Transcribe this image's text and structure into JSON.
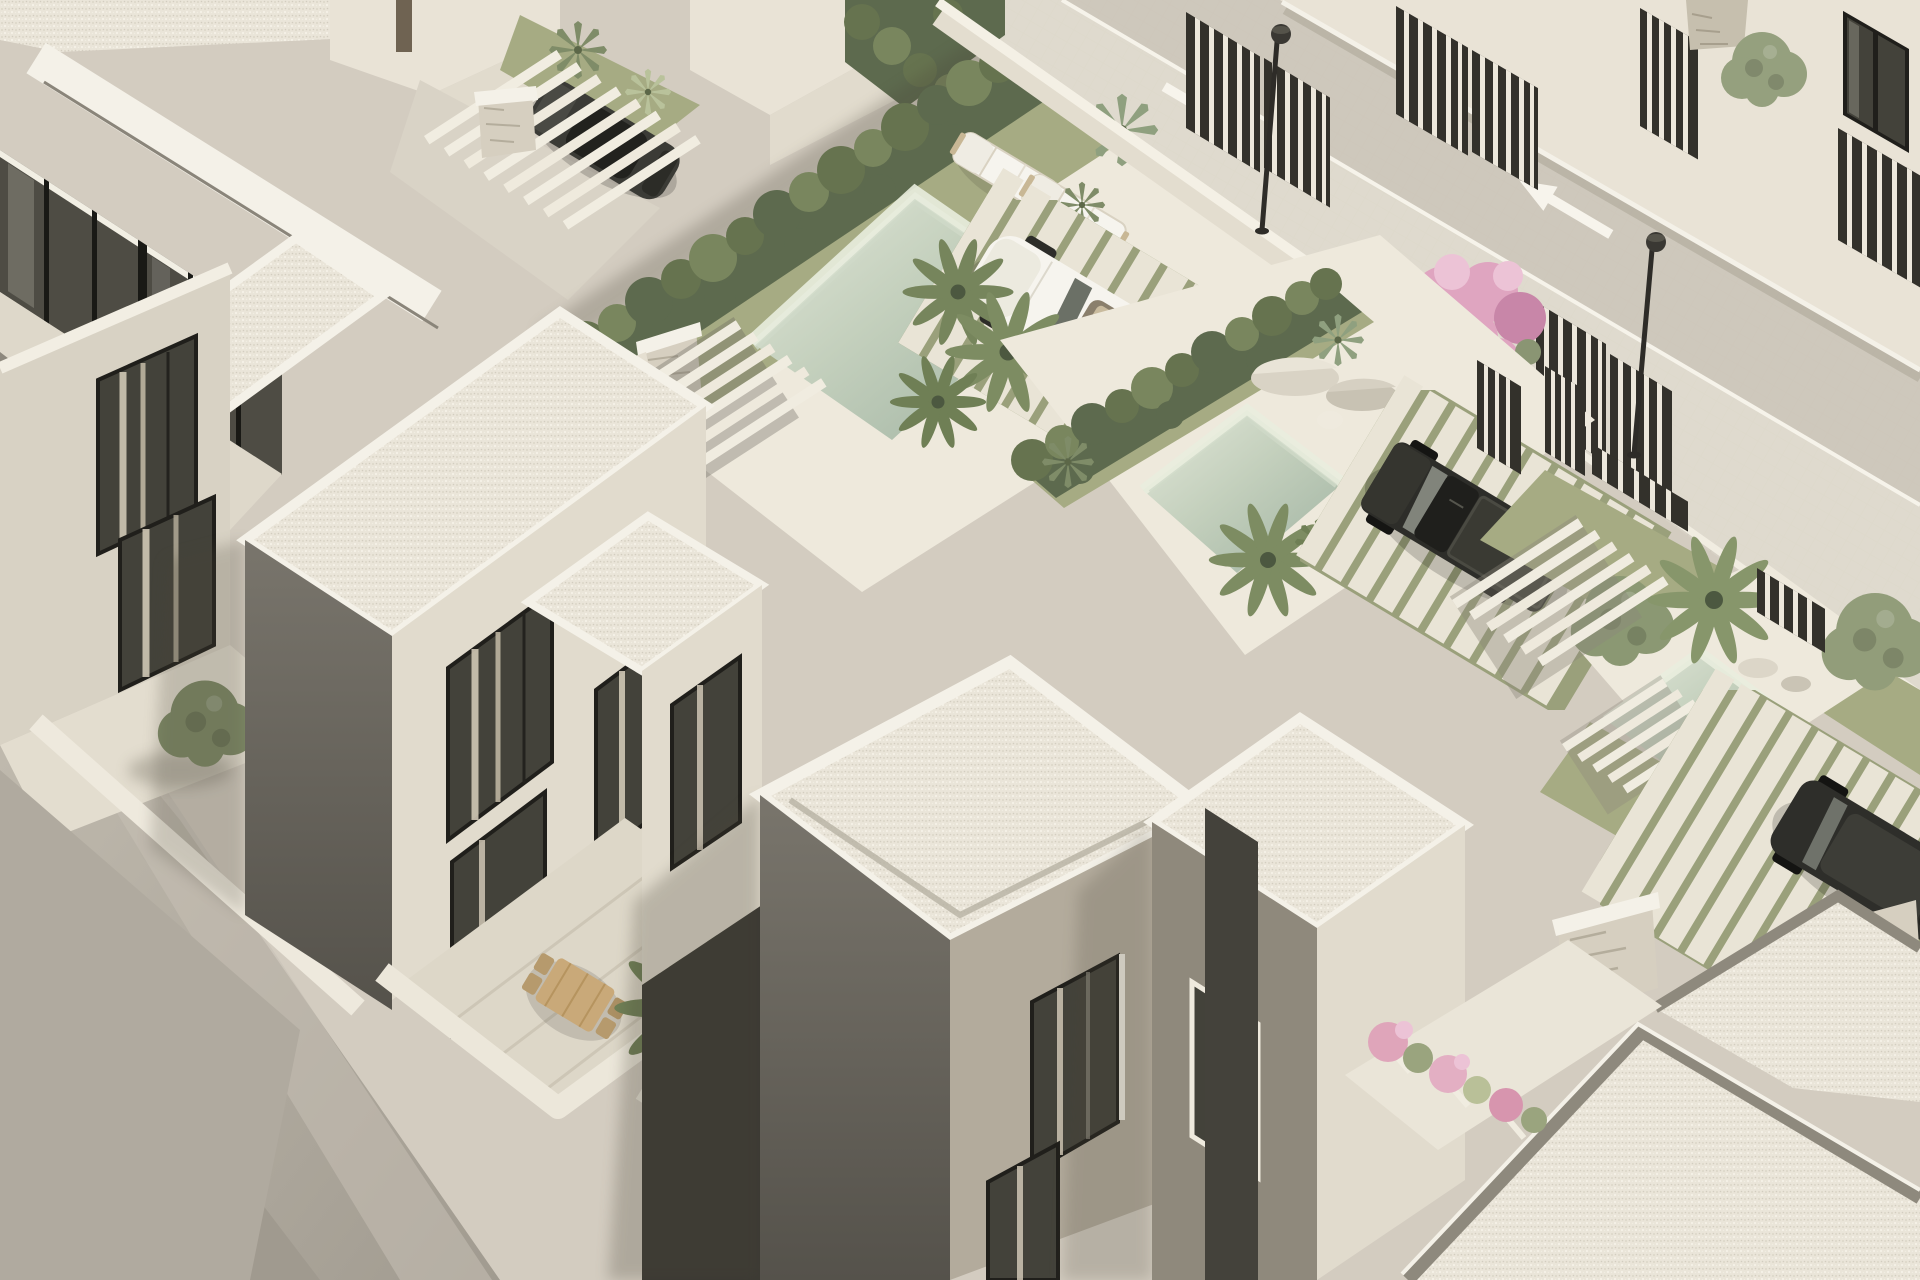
{
  "scene": {
    "label": "Aerial 3D architectural rendering of a modern white villa residential development with private pools, landscaped courtyards, paver streets and parked cars",
    "view": "high-angle aerial, near-isometric",
    "lighting": "bright daylight, sun from upper right, soft shadows falling to the lower left"
  },
  "palette": {
    "ground": "#d3ccc0",
    "ground_dark": "#b0aa9f",
    "ground_deep": "#a09a8f",
    "street": "#d7d1c5",
    "street_band": "#cdc7ba",
    "sidewalk": "#e1dccf",
    "road_line": "#f6f3ea",
    "roof_gravel": "#eae5d9",
    "parapet_white": "#f4f1e8",
    "parapet_grey": "#8e897d",
    "wall_sun": "#e9e3d6",
    "wall_light": "#d8d2c4",
    "wall_cream": "#e1dbcd",
    "wall_taupe": "#b3ab9c",
    "wall_grey": "#8f897c",
    "wall_dark": "#6e6a61",
    "wall_deep": "#4a473f",
    "glass_dark": "#43423a",
    "frame_dark": "#201f1b",
    "curtain": "#d8cfbc",
    "hedge_dark": "#5d6a4e",
    "hedge_mid": "#66734f",
    "hedge_light": "#79865e",
    "grass": "#a6ab83",
    "grass_light": "#c6cc9f",
    "water_light": "#e2e7d9",
    "water_deep": "#9fb2a1",
    "pink": "#dfa5c0",
    "pink_deep": "#c886a8",
    "wood": "#c9a979",
    "fence_dark": "#33312b",
    "fence_slit": "#ece7db",
    "car_white": "#f6f4ee",
    "car_dark": "#34342f",
    "truck_dark": "#2d2d29",
    "stone": "#d6cfc0",
    "shadow": "#4a4437",
    "deck": "#eee9dc"
  },
  "inventory": {
    "villa_blocks_visible": 10,
    "gravel_flat_roofs": 9,
    "swimming_pools": 3,
    "sun_loungers": 2,
    "outdoor_dining": {
      "wooden_tables": 1,
      "wooden_chairs": 4
    },
    "cars": {
      "white_convertible": 1,
      "dark_hatchback": 1,
      "dark_pickup_truck": 1,
      "dark_suv": 1
    },
    "street_lamps": 2,
    "road_direction_arrows": 2,
    "cypress_hedge_rows": 2,
    "bougainvillea_clusters": 1,
    "pink_flower_planters": 3,
    "decorative_stones": 5,
    "fan_palms": 8,
    "agave_plants": 6,
    "round_trees": 4,
    "slatted_fence_panels": 12,
    "pergola_beam_structures": 3,
    "stone_clad_pillars": 5
  },
  "street": {
    "surface": "light paver blocks laid diagonally",
    "markings": [
      "solid white lane lines",
      "white curb band"
    ],
    "arrows": [
      "straight arrow pointing down-right",
      "straight arrow pointing up-left"
    ]
  }
}
